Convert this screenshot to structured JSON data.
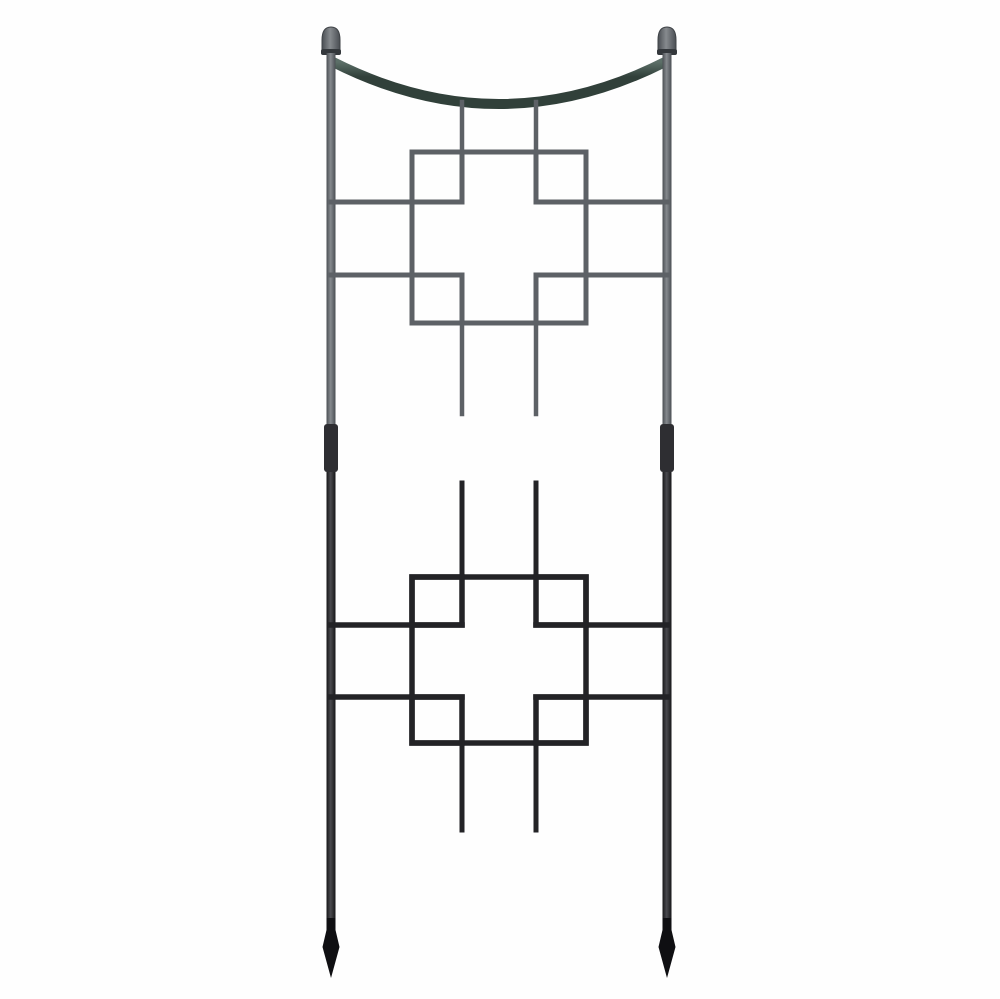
{
  "image": {
    "type": "product-photo",
    "alt": "Black and gray iron garden trellis with curved dip top, ball finials, two square-on-squares cross panels, ladder-style crossbars and pointed spear feet",
    "background_color": "#fefefe",
    "colors": {
      "background": "#fefefe",
      "upper_metal": "#5d6166",
      "upper_metal_dark": "#4a4e53",
      "upper_post_hi": "#868a8e",
      "arc_green": "#31403a",
      "arc_green_hi": "#5c6f68",
      "mid_bar_upper": "#47474c",
      "mid_bar_lower": "#39393d",
      "coupler": "#2e2e32",
      "lower_metal": "#232326",
      "lower_post_hi": "#4a4a4f",
      "bottom_bar": "#2a2a2e",
      "leg_black": "#161618",
      "foot_black": "#0f0f12"
    }
  }
}
